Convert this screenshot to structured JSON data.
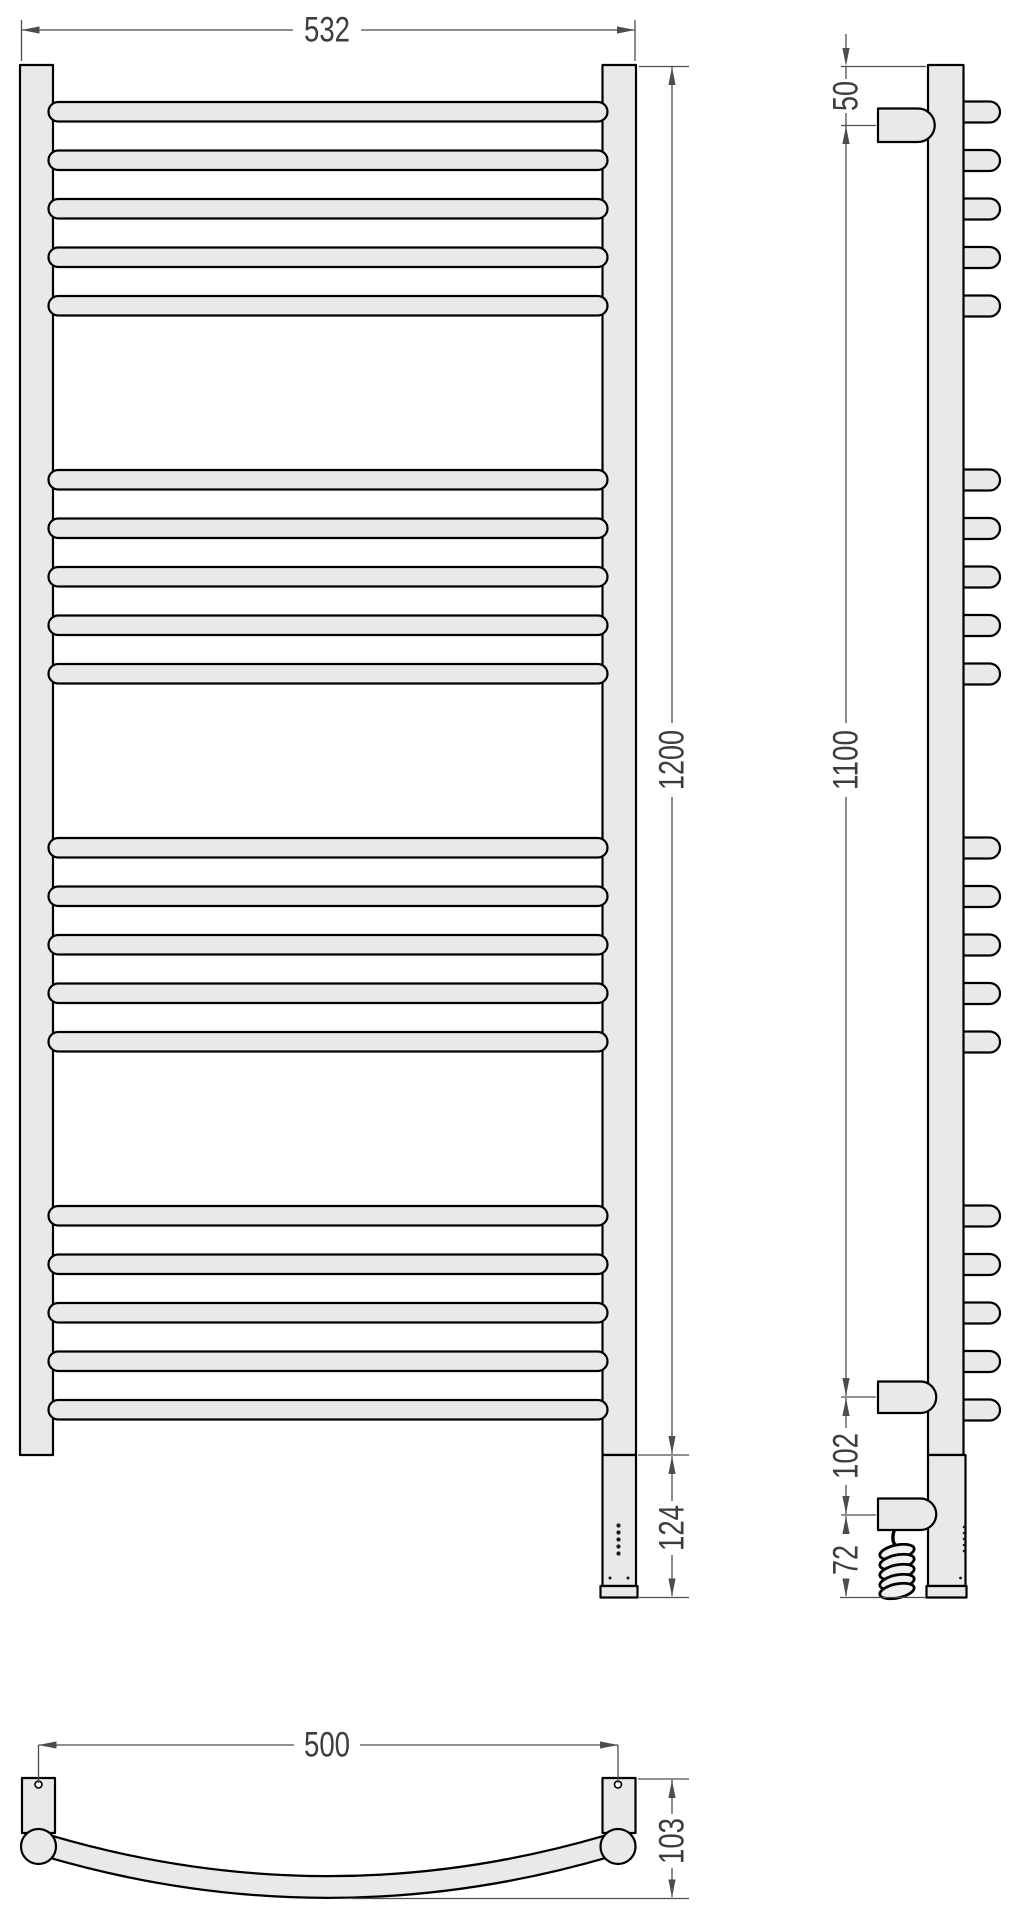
{
  "meta": {
    "type": "technical-drawing",
    "subject": "ladder towel rail drying rack, three orthographic views with dimensions",
    "units": "mm"
  },
  "colors": {
    "background": "#ffffff",
    "part_fill": "#e9e9e9",
    "part_outline": "#000000",
    "dimension_line": "#4d4d4d",
    "dimension_text": "#3d3d3d"
  },
  "views": {
    "front": {
      "name": "front view",
      "rail_count": 20,
      "rail_groups": 4,
      "rails_per_group": 5,
      "led_indicator_count": 5,
      "rail_tops_px": [
        102,
        150.5,
        199,
        247.5,
        296,
        470,
        518.5,
        567,
        615.5,
        664,
        838,
        886.5,
        935,
        983.5,
        1032,
        1206,
        1254.5,
        1303,
        1351.5,
        1400
      ],
      "dimensions": {
        "width": "532",
        "height": "1200",
        "heater_section": "124"
      }
    },
    "side": {
      "name": "side view",
      "bracket_count": 3,
      "dimensions": {
        "top_to_bracket": "50",
        "bracket_spacing": "1100",
        "bracket_to_cable_bracket": "102",
        "cable_bracket_to_floor": "72"
      }
    },
    "bottom": {
      "name": "bottom view",
      "dimensions": {
        "mount_spacing": "500",
        "depth": "103"
      }
    }
  },
  "labels": {
    "dim_532": "532",
    "dim_1200": "1200",
    "dim_124": "124",
    "dim_50": "50",
    "dim_1100": "1100",
    "dim_102": "102",
    "dim_72": "72",
    "dim_500": "500",
    "dim_103": "103"
  }
}
